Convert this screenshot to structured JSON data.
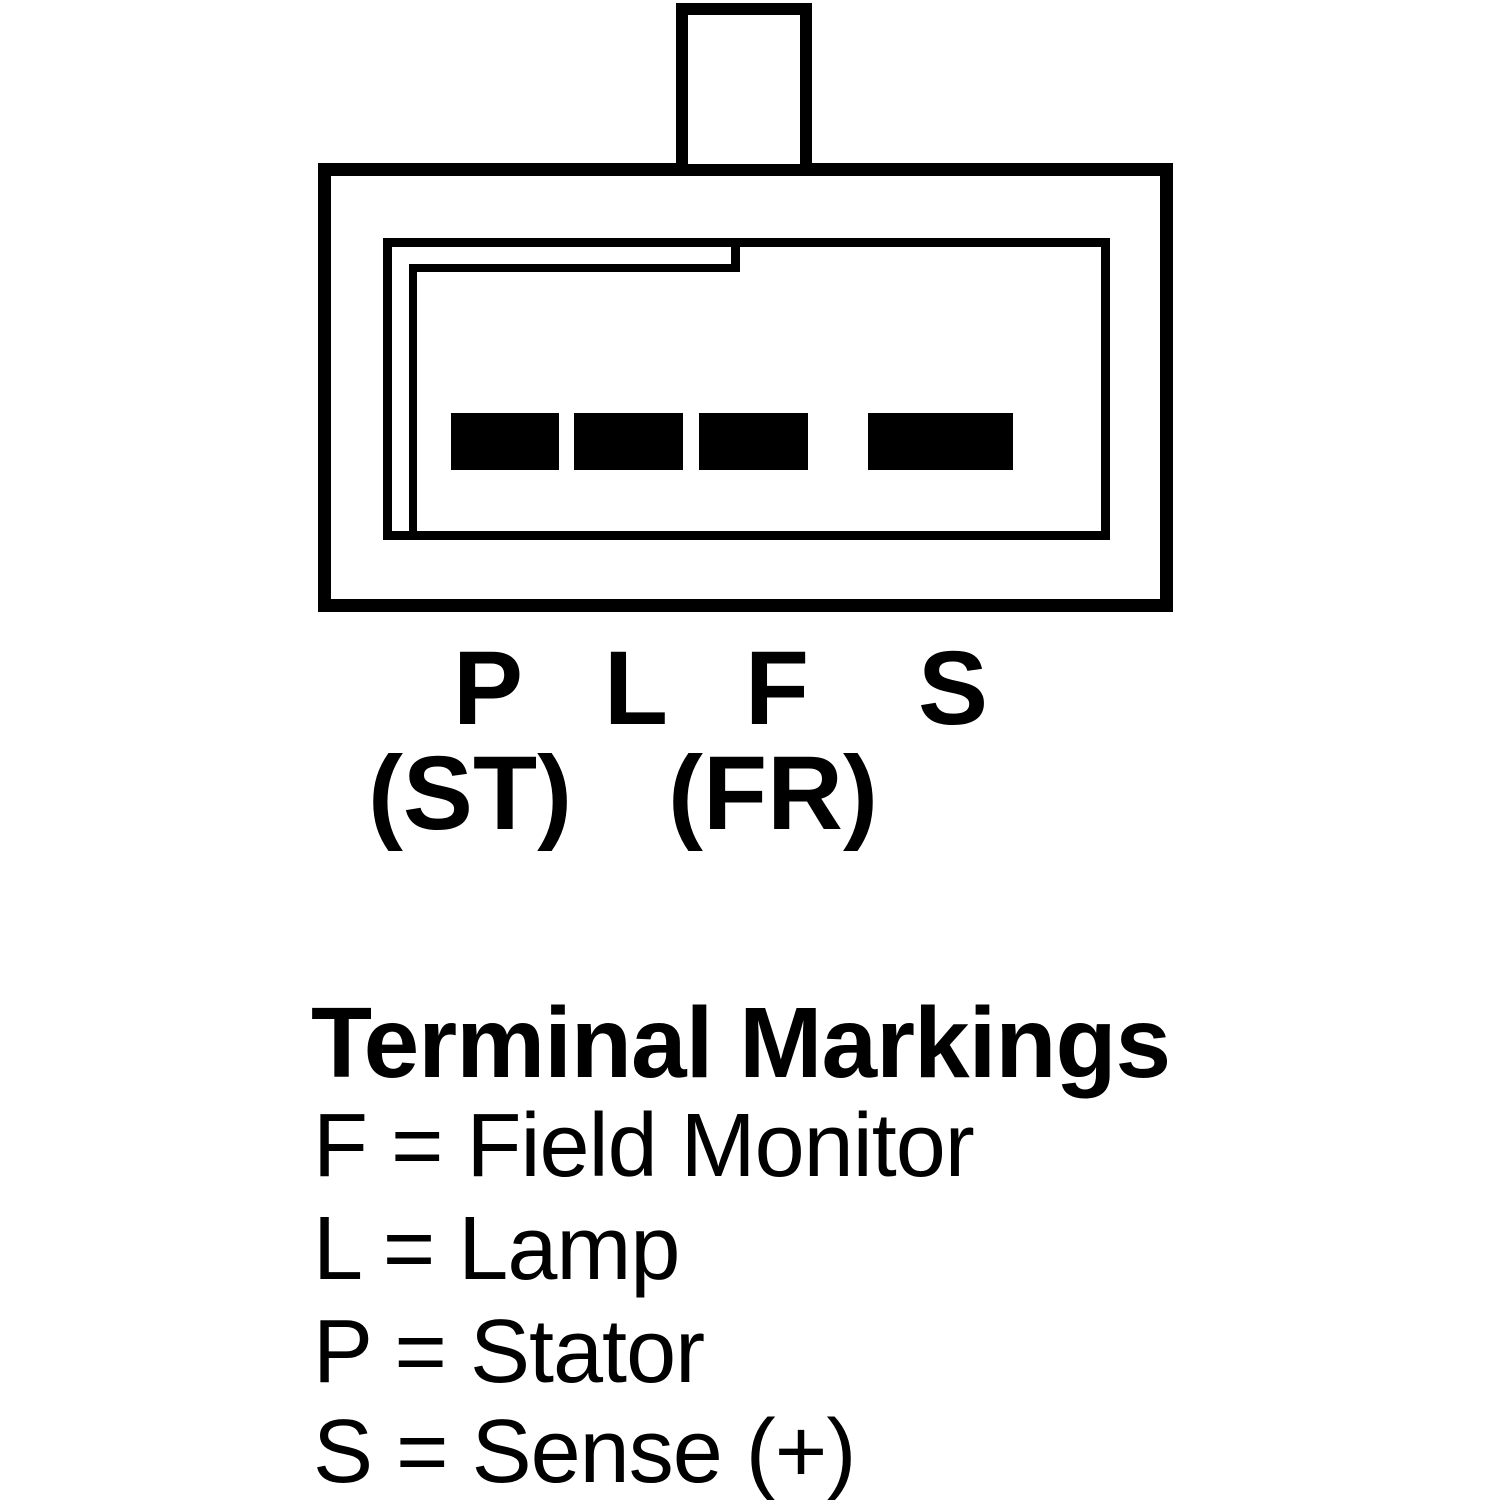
{
  "colors": {
    "ink": "#000000",
    "paper": "#ffffff"
  },
  "connector": {
    "pins": [
      "P",
      "L",
      "F",
      "S"
    ],
    "alt_pins": [
      "(ST)",
      "(FR)"
    ]
  },
  "legend": {
    "title": "Terminal Markings",
    "entries": [
      "F = Field Monitor",
      "L = Lamp",
      "P = Stator",
      "S = Sense (+)"
    ]
  }
}
